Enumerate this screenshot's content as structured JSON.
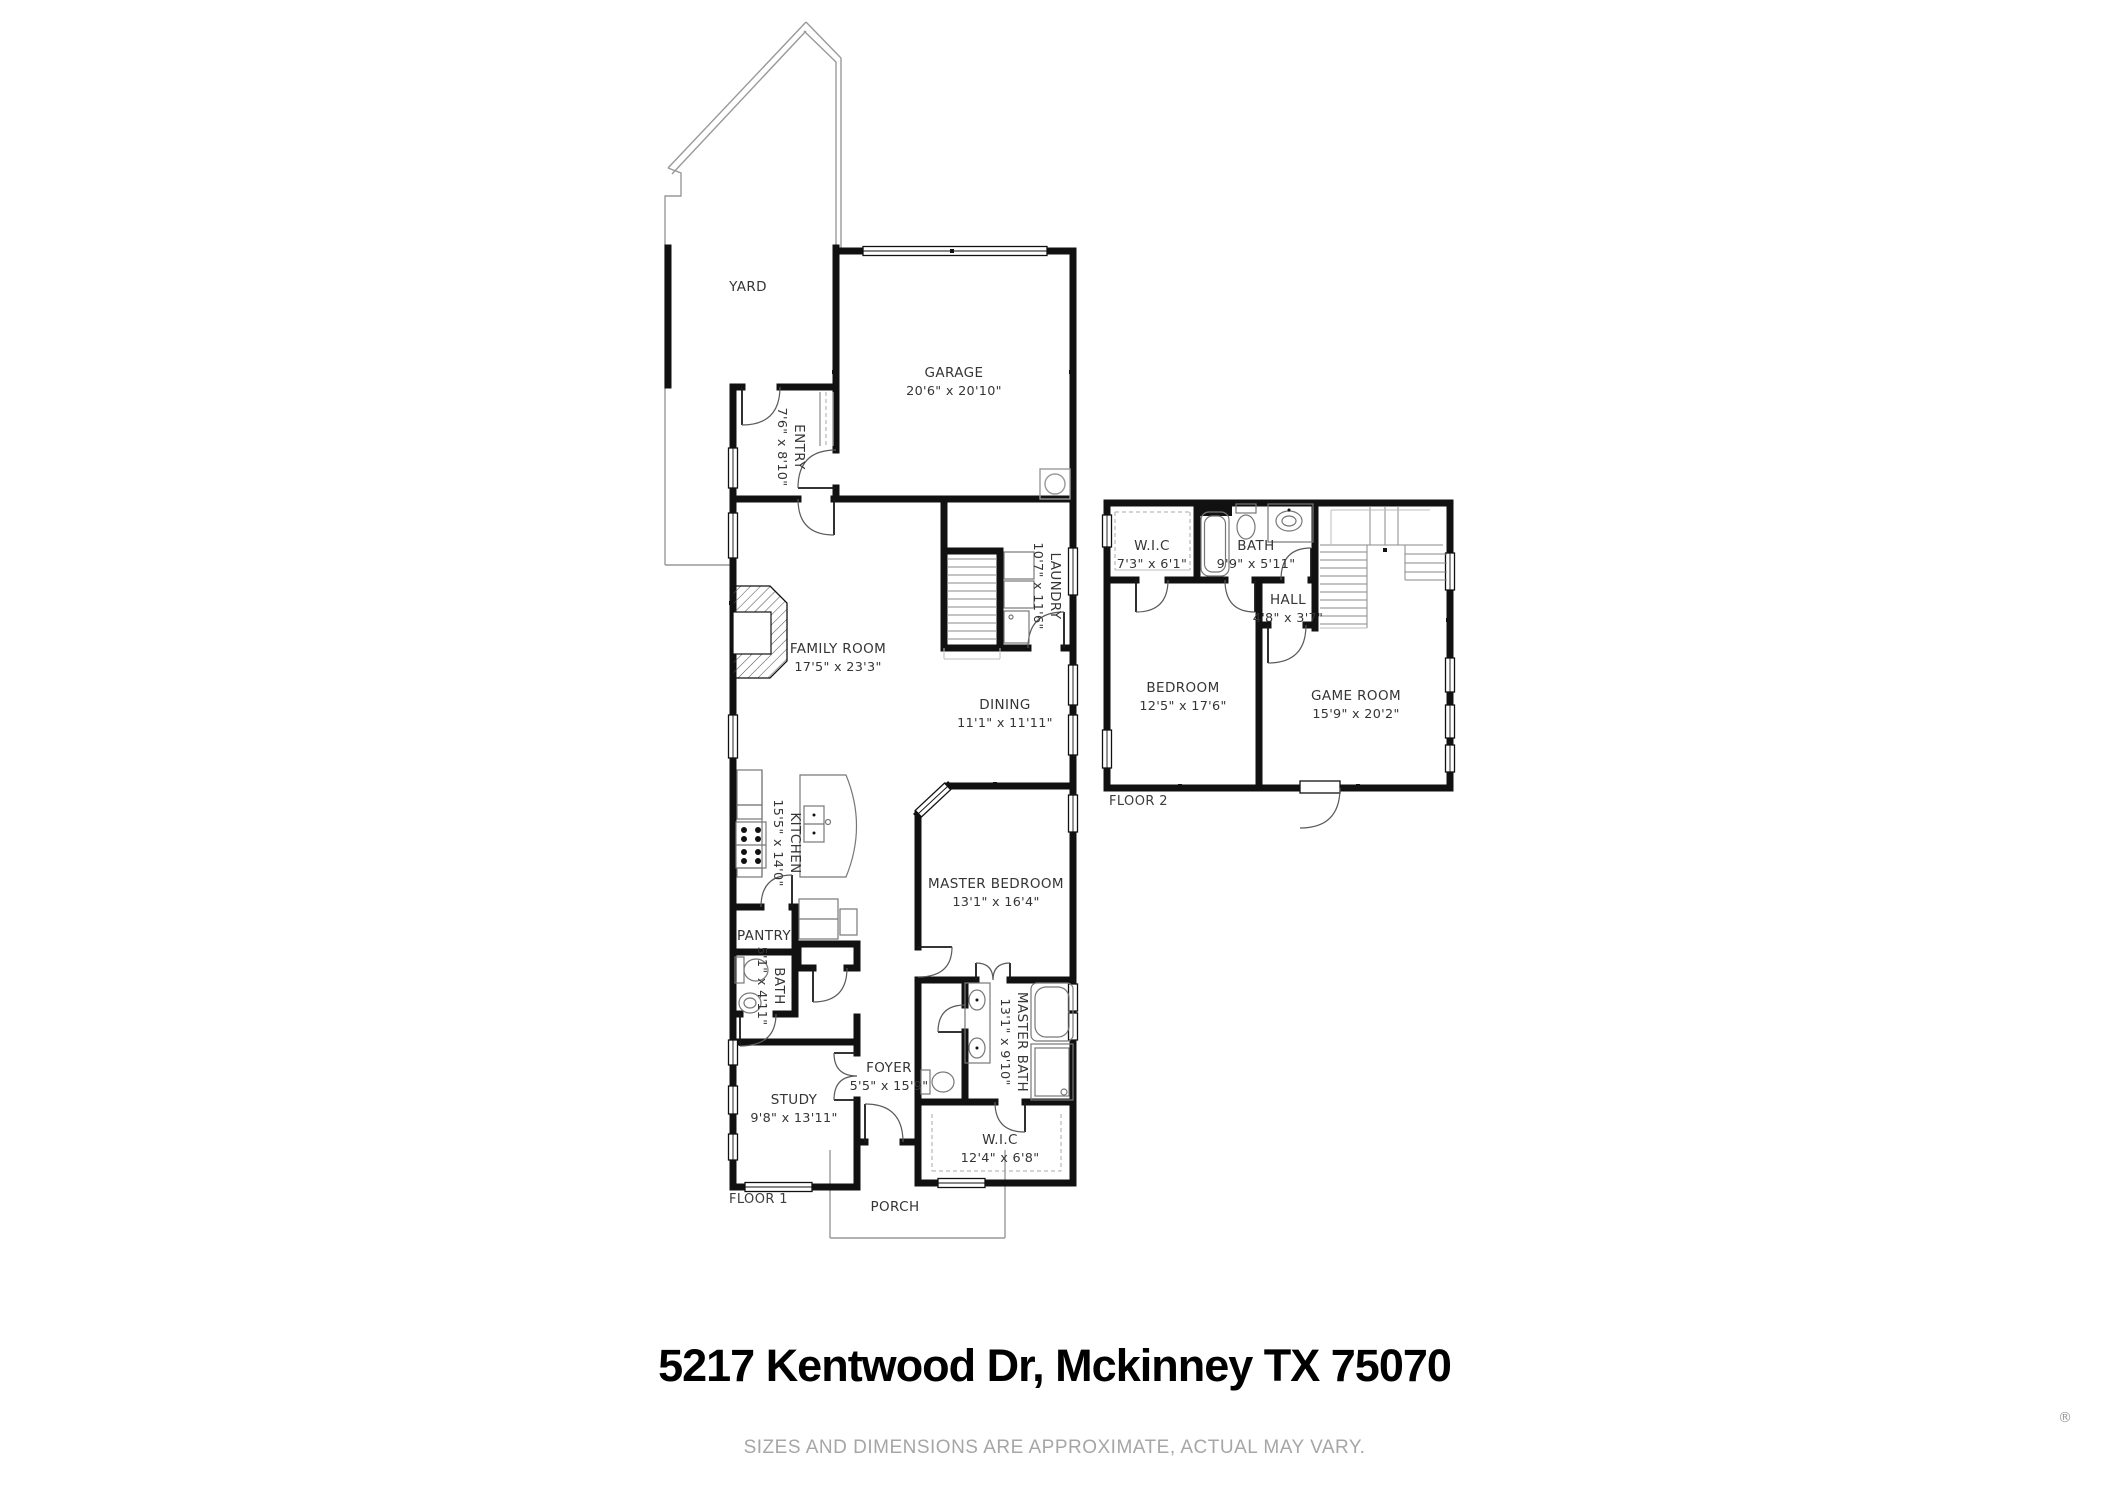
{
  "title": {
    "address": "5217 Kentwood Dr, Mckinney TX 75070"
  },
  "footer": {
    "disclaimer": "SIZES AND DIMENSIONS ARE APPROXIMATE, ACTUAL MAY VARY.",
    "registered_mark": "®"
  },
  "floor1": {
    "label": "FLOOR 1",
    "rooms": {
      "yard": {
        "name": "YARD"
      },
      "garage": {
        "name": "GARAGE",
        "dims": "20'6\" x 20'10\""
      },
      "entry": {
        "name": "ENTRY",
        "dims": "7'6\" x 8'10\""
      },
      "laundry": {
        "name": "LAUNDRY",
        "dims": "10'7\" x 11'6\""
      },
      "family_room": {
        "name": "FAMILY ROOM",
        "dims": "17'5\" x 23'3\""
      },
      "dining": {
        "name": "DINING",
        "dims": "11'1\" x 11'11\""
      },
      "kitchen": {
        "name": "KITCHEN",
        "dims": "15'5\" x 14'0\""
      },
      "pantry": {
        "name": "PANTRY"
      },
      "bath": {
        "name": "BATH",
        "dims": "5'1\" x 4'11\""
      },
      "master_bedroom": {
        "name": "MASTER BEDROOM",
        "dims": "13'1\" x 16'4\""
      },
      "master_bath": {
        "name": "MASTER BATH",
        "dims": "13'1\" x 9'10\""
      },
      "wic": {
        "name": "W.I.C",
        "dims": "12'4\" x 6'8\""
      },
      "study": {
        "name": "STUDY",
        "dims": "9'8\" x 13'11\""
      },
      "foyer": {
        "name": "FOYER",
        "dims": "5'5\" x 15'9\""
      },
      "porch": {
        "name": "PORCH"
      }
    }
  },
  "floor2": {
    "label": "FLOOR 2",
    "rooms": {
      "wic": {
        "name": "W.I.C",
        "dims": "7'3\" x 6'1\""
      },
      "bath": {
        "name": "BATH",
        "dims": "9'9\" x 5'11\""
      },
      "hall": {
        "name": "HALL",
        "dims": "4'8\" x 3'7\""
      },
      "bedroom": {
        "name": "BEDROOM",
        "dims": "12'5\" x 17'6\""
      },
      "game_room": {
        "name": "GAME ROOM",
        "dims": "15'9\" x 20'2\""
      }
    }
  }
}
